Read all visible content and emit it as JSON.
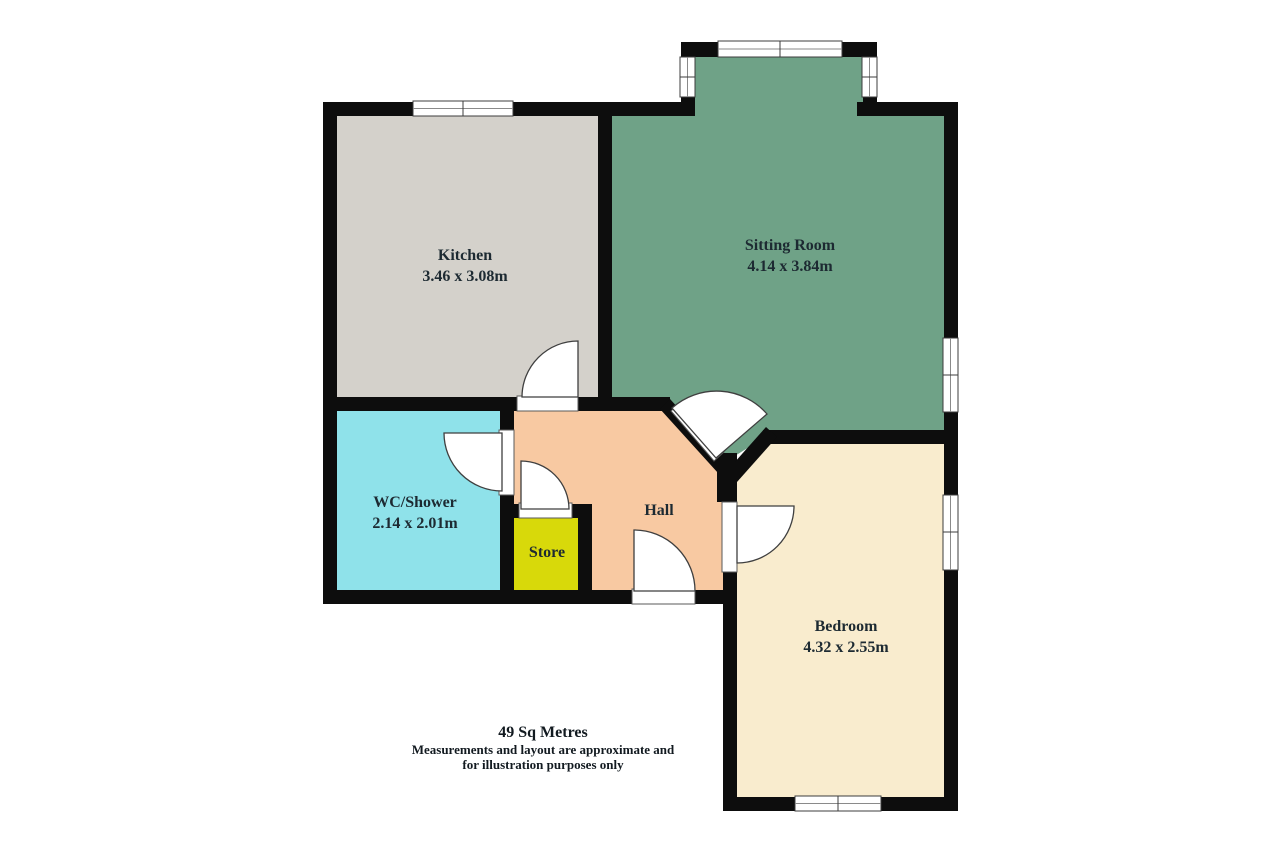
{
  "title": "Floor plan",
  "colors": {
    "background": "#ffffff",
    "wall": "#0d0d0d",
    "kitchen": "#d4d1cb",
    "sitting_room": "#6fa287",
    "wc_shower": "#8fe2ea",
    "store": "#d8d90a",
    "hall": "#f8c9a2",
    "bedroom": "#f9ecce",
    "door_fill": "#ffffff",
    "window_fill": "#ffffff",
    "text": "#1d2a32"
  },
  "rooms": [
    {
      "id": "kitchen",
      "name": "Kitchen",
      "dimensions": "3.46 x 3.08m"
    },
    {
      "id": "sitting-room",
      "name": "Sitting Room",
      "dimensions": "4.14 x 3.84m"
    },
    {
      "id": "wc-shower",
      "name": "WC/Shower",
      "dimensions": "2.14 x 2.01m"
    },
    {
      "id": "store",
      "name": "Store",
      "dimensions": ""
    },
    {
      "id": "hall",
      "name": "Hall",
      "dimensions": ""
    },
    {
      "id": "bedroom",
      "name": "Bedroom",
      "dimensions": "4.32 x 2.55m"
    }
  ],
  "footer": {
    "area": "49 Sq Metres",
    "disclaimer_line1": "Measurements and layout are approximate and",
    "disclaimer_line2": "for illustration purposes only"
  }
}
